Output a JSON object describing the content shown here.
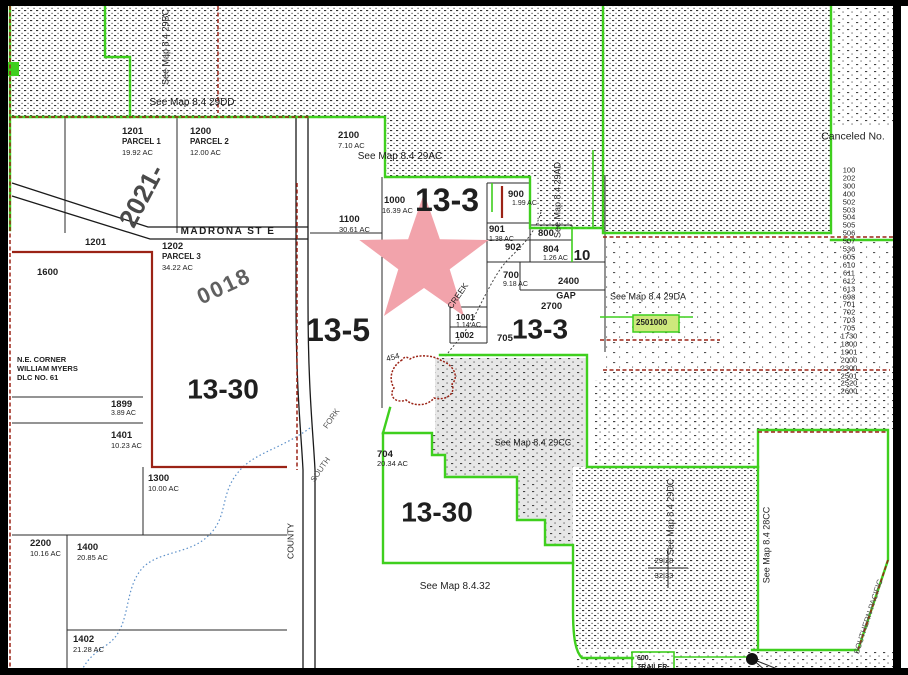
{
  "map": {
    "colors": {
      "green": "#3fcf1e",
      "red": "#9b2316",
      "black": "#1a1a1a",
      "star": "#f2a3ab",
      "highlight": "#cde87c",
      "gray": "#e7e7e7",
      "creek": "#5b8fc9"
    },
    "star": {
      "cx": 424,
      "cy": 261,
      "outer_r": 68,
      "inner_r": 27
    },
    "labels": [
      {
        "n": "section-label-13-3",
        "t": "13-3",
        "x": 447,
        "y": 201,
        "s": 32,
        "b": 1,
        "a": "c"
      },
      {
        "n": "section-label-13-5",
        "t": "13-5",
        "x": 338,
        "y": 331,
        "s": 32,
        "b": 1,
        "a": "c"
      },
      {
        "n": "section-label-13-30",
        "t": "13-30",
        "x": 223,
        "y": 389,
        "s": 28,
        "b": 1,
        "a": "c"
      },
      {
        "n": "section-label-13-3b",
        "t": "13-3",
        "x": 540,
        "y": 329,
        "s": 28,
        "b": 1,
        "a": "c"
      },
      {
        "n": "section-label-13-30b",
        "t": "13-30",
        "x": 437,
        "y": 512,
        "s": 28,
        "b": 1,
        "a": "c"
      },
      {
        "n": "section-label-10",
        "t": "10",
        "x": 582,
        "y": 256,
        "s": 15,
        "b": 1,
        "a": "c"
      },
      {
        "n": "road-label-2021",
        "t": "2021-",
        "x": 142,
        "y": 196,
        "s": 26,
        "b": 1,
        "r": -62,
        "a": "c",
        "c": "#4a4a4a"
      },
      {
        "n": "road-label-0018",
        "t": "0018",
        "x": 224,
        "y": 286,
        "s": 22,
        "b": 1,
        "r": -25,
        "a": "c",
        "c": "#606060",
        "ls": 2
      },
      {
        "n": "see-map-label",
        "t": "See Map 8.4 29DD",
        "x": 192,
        "y": 103,
        "s": 10,
        "a": "c"
      },
      {
        "n": "see-map-label",
        "t": "See Map 8.4 29AC",
        "x": 400,
        "y": 157,
        "s": 10,
        "a": "c"
      },
      {
        "n": "see-map-label",
        "t": "See Map 8.4 29DA",
        "x": 648,
        "y": 297,
        "s": 9,
        "a": "c"
      },
      {
        "n": "see-map-label",
        "t": "See Map 8.4 29CC",
        "x": 533,
        "y": 443,
        "s": 9,
        "a": "c"
      },
      {
        "n": "see-map-label",
        "t": "See Map 8.4.32",
        "x": 455,
        "y": 587,
        "s": 10,
        "a": "c"
      },
      {
        "n": "see-map-label",
        "t": "See Map 8.4 29BC",
        "x": 166,
        "y": 47,
        "s": 9,
        "r": -90,
        "a": "c"
      },
      {
        "n": "see-map-label",
        "t": "See Map 8.4 29AD",
        "x": 558,
        "y": 200,
        "s": 9,
        "r": -90,
        "a": "c"
      },
      {
        "n": "see-map-label",
        "t": "See Map 8.4 29DC",
        "x": 671,
        "y": 517,
        "s": 9,
        "r": -90,
        "a": "c"
      },
      {
        "n": "see-map-label",
        "t": "See Map 8.4 28CC",
        "x": 767,
        "y": 545,
        "s": 9,
        "r": -90,
        "a": "c"
      },
      {
        "n": "railroad-label",
        "t": "SOUTHERN PACIFIC",
        "x": 869,
        "y": 617,
        "s": 8,
        "r": -72,
        "a": "c",
        "c": "#555555"
      },
      {
        "n": "canceled-no-heading",
        "t": "Canceled No.",
        "x": 853,
        "y": 137,
        "s": 10.5,
        "a": "c"
      },
      {
        "n": "canceled-no-list",
        "lines": [
          "100",
          "202",
          "300",
          "400",
          "502",
          "503",
          "504",
          "505",
          "506",
          "507",
          "536",
          "605",
          "610",
          "611",
          "612",
          "613",
          "698",
          "701",
          "702",
          "703",
          "705",
          "1730",
          "1800",
          "1901",
          "2000",
          "2300",
          "2501",
          "2520",
          "2600"
        ],
        "x": 849,
        "y": 281,
        "s": 7.5,
        "lh": 7.9,
        "a": "c",
        "align": "center"
      },
      {
        "n": "madrona-street-label",
        "t": "MADRONA ST E",
        "x": 228,
        "y": 232,
        "s": 10,
        "b": 1,
        "a": "c",
        "ls": 1.5
      },
      {
        "n": "county-road-label",
        "t": "COUNTY",
        "x": 291,
        "y": 541,
        "s": 8.5,
        "r": -90,
        "a": "c"
      },
      {
        "n": "creek-label",
        "t": "CREEK",
        "x": 458,
        "y": 296,
        "s": 8.5,
        "r": -55,
        "a": "c"
      },
      {
        "n": "creek-label",
        "t": "FORK",
        "x": 332,
        "y": 419,
        "s": 8,
        "r": -55,
        "a": "c",
        "c": "#555555"
      },
      {
        "n": "creek-label",
        "t": "SOUTH",
        "x": 321,
        "y": 470,
        "s": 8,
        "r": -55,
        "a": "c",
        "c": "#555555"
      },
      {
        "n": "spot-elevation-label",
        "t": "454",
        "x": 393,
        "y": 358,
        "s": 8,
        "r": -15,
        "a": "c"
      },
      {
        "n": "gap-label",
        "t": "GAP",
        "x": 566,
        "y": 296,
        "s": 9,
        "b": 1,
        "a": "c"
      },
      {
        "n": "section-corner-label",
        "t": "29|28",
        "x": 664,
        "y": 561,
        "s": 7.5,
        "a": "c"
      },
      {
        "n": "section-corner-label",
        "t": "32|33",
        "x": 664,
        "y": 576,
        "s": 7.5,
        "a": "c"
      },
      {
        "n": "parcel-label",
        "t": "1201",
        "x": 122,
        "y": 127,
        "s": 9.5,
        "b": 1
      },
      {
        "n": "parcel-label",
        "t": "PARCEL 1",
        "x": 122,
        "y": 138,
        "s": 8,
        "b": 1
      },
      {
        "n": "parcel-acreage",
        "t": "19.92 AC",
        "x": 122,
        "y": 149,
        "s": 7.5
      },
      {
        "n": "parcel-label",
        "t": "1200",
        "x": 190,
        "y": 127,
        "s": 9.5,
        "b": 1
      },
      {
        "n": "parcel-label",
        "t": "PARCEL 2",
        "x": 190,
        "y": 138,
        "s": 8,
        "b": 1
      },
      {
        "n": "parcel-acreage",
        "t": "12.00 AC",
        "x": 190,
        "y": 149,
        "s": 7.5
      },
      {
        "n": "parcel-label",
        "t": "2100",
        "x": 338,
        "y": 131,
        "s": 9.5,
        "b": 1
      },
      {
        "n": "parcel-acreage",
        "t": "7.10 AC",
        "x": 338,
        "y": 142,
        "s": 7.5
      },
      {
        "n": "parcel-label",
        "t": "1100",
        "x": 339,
        "y": 215,
        "s": 9.5,
        "b": 1
      },
      {
        "n": "parcel-acreage",
        "t": "30.61 AC",
        "x": 339,
        "y": 226,
        "s": 7.5
      },
      {
        "n": "parcel-label",
        "t": "1000",
        "x": 384,
        "y": 196,
        "s": 9.5,
        "b": 1
      },
      {
        "n": "parcel-acreage",
        "t": "16.39 AC",
        "x": 382,
        "y": 207,
        "s": 7.5
      },
      {
        "n": "parcel-label",
        "t": "900",
        "x": 508,
        "y": 190,
        "s": 9.5,
        "b": 1
      },
      {
        "n": "parcel-acreage",
        "t": "1.99 AC",
        "x": 512,
        "y": 200,
        "s": 7
      },
      {
        "n": "parcel-label",
        "t": "901",
        "x": 489,
        "y": 225,
        "s": 9.5,
        "b": 1
      },
      {
        "n": "parcel-acreage",
        "t": "1.38 AC",
        "x": 489,
        "y": 236,
        "s": 7
      },
      {
        "n": "parcel-label",
        "t": "902",
        "x": 505,
        "y": 243,
        "s": 9.5,
        "b": 1
      },
      {
        "n": "parcel-label",
        "t": "800",
        "x": 538,
        "y": 229,
        "s": 9.5,
        "b": 1
      },
      {
        "n": "parcel-label",
        "t": "804",
        "x": 543,
        "y": 245,
        "s": 9.5,
        "b": 1
      },
      {
        "n": "parcel-acreage",
        "t": "1.26 AC",
        "x": 543,
        "y": 255,
        "s": 7
      },
      {
        "n": "parcel-label",
        "t": "700",
        "x": 503,
        "y": 271,
        "s": 9.5,
        "b": 1
      },
      {
        "n": "parcel-acreage",
        "t": "9.18 AC",
        "x": 503,
        "y": 281,
        "s": 7
      },
      {
        "n": "parcel-label",
        "t": "2400",
        "x": 558,
        "y": 277,
        "s": 9.5,
        "b": 1
      },
      {
        "n": "parcel-label",
        "t": "2700",
        "x": 541,
        "y": 302,
        "s": 9.5,
        "b": 1
      },
      {
        "n": "parcel-label",
        "t": "1001",
        "x": 456,
        "y": 313,
        "s": 8.5,
        "b": 1
      },
      {
        "n": "parcel-acreage",
        "t": "1.14 AC",
        "x": 456,
        "y": 322,
        "s": 7
      },
      {
        "n": "parcel-label",
        "t": "1002",
        "x": 455,
        "y": 331,
        "s": 8.5,
        "b": 1
      },
      {
        "n": "parcel-label",
        "t": "705",
        "x": 497,
        "y": 334,
        "s": 9.5,
        "b": 1
      },
      {
        "n": "highlighted-parcel-label",
        "t": "2501000",
        "x": 636,
        "y": 319,
        "s": 8,
        "b": 1
      },
      {
        "n": "parcel-label",
        "t": "1202",
        "x": 162,
        "y": 242,
        "s": 9.5,
        "b": 1
      },
      {
        "n": "parcel-label",
        "t": "PARCEL 3",
        "x": 162,
        "y": 253,
        "s": 8,
        "b": 1
      },
      {
        "n": "parcel-acreage",
        "t": "34.22 AC",
        "x": 162,
        "y": 264,
        "s": 7.5
      },
      {
        "n": "parcel-label",
        "t": "1201",
        "x": 85,
        "y": 238,
        "s": 9.5,
        "b": 1
      },
      {
        "n": "parcel-label",
        "t": "1600",
        "x": 37,
        "y": 268,
        "s": 9.5,
        "b": 1
      },
      {
        "n": "survey-note",
        "lines": [
          "N.E. CORNER",
          "WILLIAM MYERS",
          "DLC NO. 61"
        ],
        "x": 17,
        "y": 355,
        "s": 7.5,
        "b": 1,
        "lh": 9
      },
      {
        "n": "parcel-label",
        "t": "1899",
        "x": 111,
        "y": 400,
        "s": 9.5,
        "b": 1
      },
      {
        "n": "parcel-acreage",
        "t": "3.89 AC",
        "x": 111,
        "y": 410,
        "s": 7
      },
      {
        "n": "parcel-label",
        "t": "1401",
        "x": 111,
        "y": 431,
        "s": 9.5,
        "b": 1
      },
      {
        "n": "parcel-acreage",
        "t": "10.23 AC",
        "x": 111,
        "y": 442,
        "s": 7.5
      },
      {
        "n": "parcel-label",
        "t": "1300",
        "x": 148,
        "y": 474,
        "s": 9.5,
        "b": 1
      },
      {
        "n": "parcel-acreage",
        "t": "10.00 AC",
        "x": 148,
        "y": 485,
        "s": 7.5
      },
      {
        "n": "parcel-label",
        "t": "2200",
        "x": 30,
        "y": 539,
        "s": 9.5,
        "b": 1
      },
      {
        "n": "parcel-acreage",
        "t": "10.16 AC",
        "x": 30,
        "y": 550,
        "s": 7.5
      },
      {
        "n": "parcel-label",
        "t": "1400",
        "x": 77,
        "y": 543,
        "s": 9.5,
        "b": 1
      },
      {
        "n": "parcel-acreage",
        "t": "20.85 AC",
        "x": 77,
        "y": 554,
        "s": 7.5
      },
      {
        "n": "parcel-label",
        "t": "1402",
        "x": 73,
        "y": 635,
        "s": 9.5,
        "b": 1
      },
      {
        "n": "parcel-acreage",
        "t": "21.28 AC",
        "x": 73,
        "y": 646,
        "s": 7.5
      },
      {
        "n": "parcel-label",
        "t": "704",
        "x": 377,
        "y": 450,
        "s": 9.5,
        "b": 1
      },
      {
        "n": "parcel-acreage",
        "t": "20.34 AC",
        "x": 377,
        "y": 460,
        "s": 7.5
      },
      {
        "n": "trailer-park-label",
        "lines": [
          "600",
          "TRAILER"
        ],
        "x": 637,
        "y": 655,
        "s": 7,
        "b": 1,
        "lh": 8.5
      }
    ]
  }
}
